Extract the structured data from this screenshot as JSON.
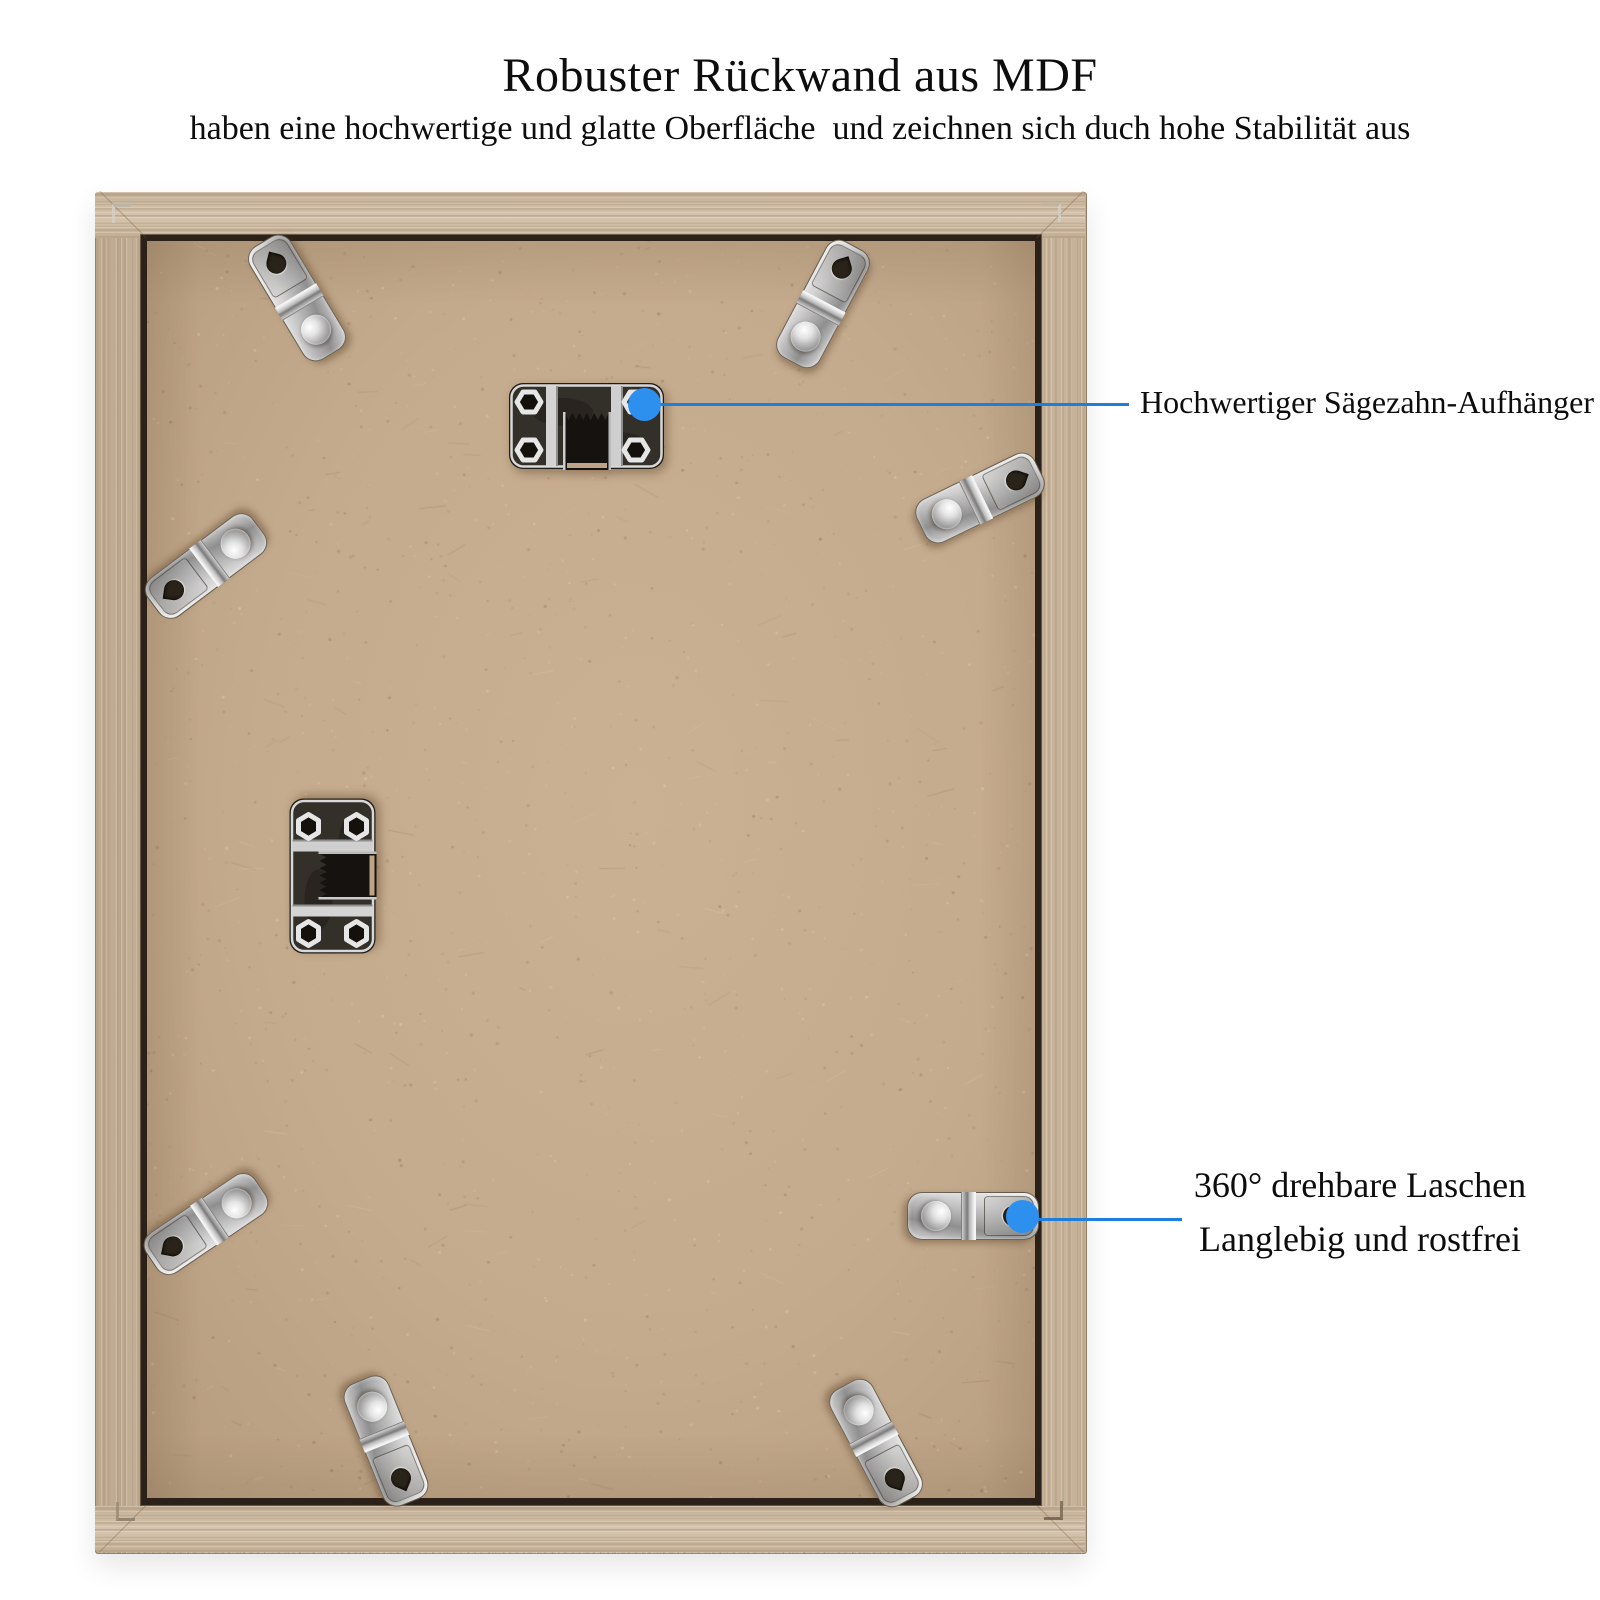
{
  "page": {
    "background": "#ffffff"
  },
  "header": {
    "title": "Robuster Rückwand aus MDF",
    "subtitle": "haben eine hochwertige und glatte Oberfläche  und zeichnen sich duch hohe Stabilität aus"
  },
  "callouts": {
    "sawtooth": {
      "label": "Hochwertiger Sägezahn-Aufhänger"
    },
    "tabs": {
      "line1": "360° drehbare Laschen",
      "line2": "Langlebig und rostfrei"
    }
  },
  "hardware": {
    "sawtooth_hanger_count": 2,
    "rotating_tab_count": 8
  },
  "colors": {
    "accent_blue": "#2e90ee",
    "line_blue": "#1d7fdb",
    "mdf_tan": "#c5ab8d",
    "wood_oak": "#cfbca3",
    "text_black": "#0d0d0d"
  }
}
